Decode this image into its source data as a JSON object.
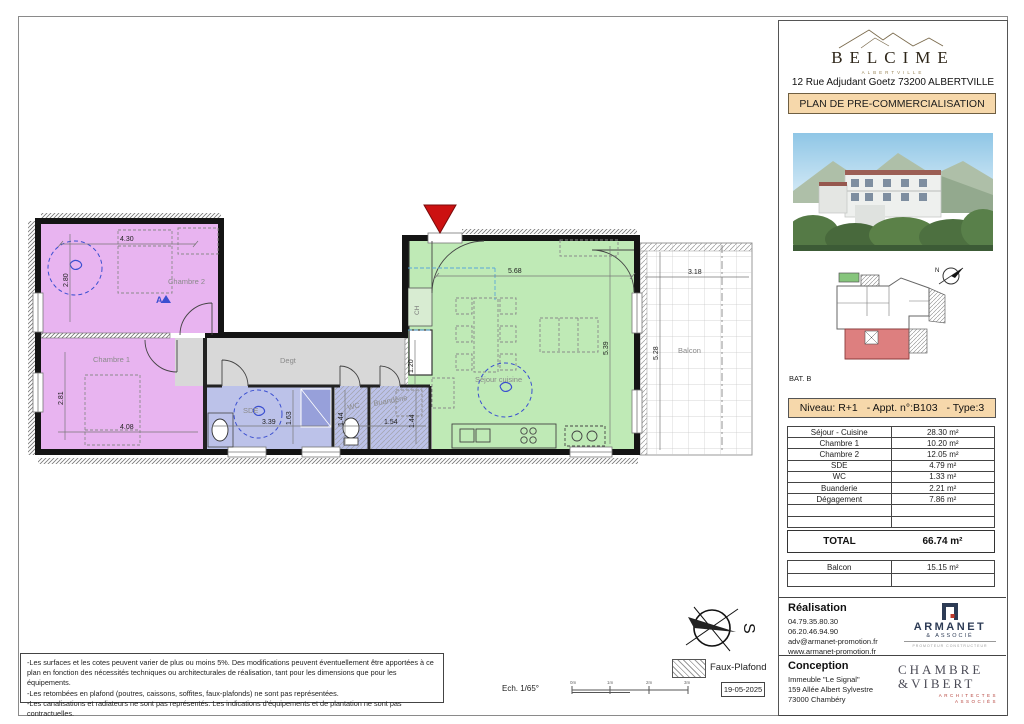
{
  "plan": {
    "rooms": {
      "chambre2": "Chambre 2",
      "chambre1": "Chambre 1",
      "degt": "Degt",
      "sde": "SDE",
      "wc": "WC",
      "buanderie": "Buanderie",
      "sejour": "Séjour cuisine",
      "balcon": "Balcon",
      "ch": "CH",
      "section_a": "A"
    },
    "dims": {
      "d430": "4.30",
      "d280": "2.80",
      "d281": "2.81",
      "d408": "4.08",
      "d568": "5.68",
      "d539": "5.39",
      "d318": "3.18",
      "d528": "5.28",
      "d339": "3.39",
      "d163": "1.63",
      "d144a": "1.44",
      "d154": "1.54",
      "d144b": "1.44",
      "d120": "1.20"
    },
    "colors": {
      "bedroom": "#e8b4f0",
      "living": "#bfeab6",
      "wet": "#bcc2e9",
      "shower": "#97a0da",
      "corridor": "#d8d8d8",
      "wall": "#141414",
      "entry_marker": "#cc1111"
    }
  },
  "sidebar": {
    "brand": {
      "name": "BELCIME",
      "sub": "ALBERTVILLE"
    },
    "address": "12 Rue Adjudant Goetz 73200 ALBERTVILLE",
    "banner": "PLAN DE PRE-COMMERCIALISATION",
    "site": {
      "label": "BAT. B",
      "north": "N"
    },
    "unit": {
      "niveau": "Niveau: R+1",
      "appt": "- Appt. n°:B103",
      "type": "- Type:3"
    },
    "areas": {
      "rows": [
        {
          "label": "Séjour - Cuisine",
          "value": "28.30 m²"
        },
        {
          "label": "Chambre 1",
          "value": "10.20 m²"
        },
        {
          "label": "Chambre 2",
          "value": "12.05 m²"
        },
        {
          "label": "SDE",
          "value": "4.79 m²"
        },
        {
          "label": "WC",
          "value": "1.33 m²"
        },
        {
          "label": "Buanderie",
          "value": "2.21 m²"
        },
        {
          "label": "Dégagement",
          "value": "7.86 m²"
        },
        {
          "label": "",
          "value": ""
        },
        {
          "label": "",
          "value": ""
        }
      ],
      "total_label": "TOTAL",
      "total_value": "66.74 m²",
      "balcon_rows": [
        {
          "label": "Balcon",
          "value": "15.15 m²"
        },
        {
          "label": "",
          "value": ""
        }
      ]
    },
    "realisation": {
      "title": "Réalisation",
      "lines": [
        "04.79.35.80.30",
        "06.20.46.94.90",
        "adv@armanet-promotion.fr",
        "www.armanet-promotion.fr"
      ]
    },
    "armanet": {
      "name": "ARMANET",
      "sub": "& ASSOCIÉ",
      "tagline": "PROMOTEUR CONSTRUCTEUR"
    },
    "conception": {
      "title": "Conception",
      "lines": [
        "Immeuble \"Le Signal\"",
        "159 Allée Albert Sylvestre",
        "73000 Chambéry"
      ]
    },
    "chambre_vibert": {
      "line1": "CHAMBRE",
      "line2": "&VIBERT",
      "sub1": "ARCHITECTES",
      "sub2": "ASSOCIÉS"
    }
  },
  "footer": {
    "notes": [
      "-Les surfaces et les cotes peuvent varier de plus ou moins 5%. Des modifications peuvent éventuellement être apportées à ce plan en fonction des nécessités techniques ou architecturales de réalisation, tant pour les dimensions que pour les équipements.",
      "-Les retombées en plafond (poutres, caissons, soffites, faux-plafonds) ne sont pas représentées.",
      "-Les canalisations et radiateurs ne sont pas représentés. Les indications d'équipements et de plantation ne sont pas contractuelles."
    ],
    "scale_label": "Ech. 1/65°",
    "scale_ticks": [
      "0m",
      "1m",
      "2m",
      "3m"
    ],
    "date": "19-05-2025",
    "legend_faux_plafond": "Faux-Plafond",
    "compass_s": "S"
  }
}
